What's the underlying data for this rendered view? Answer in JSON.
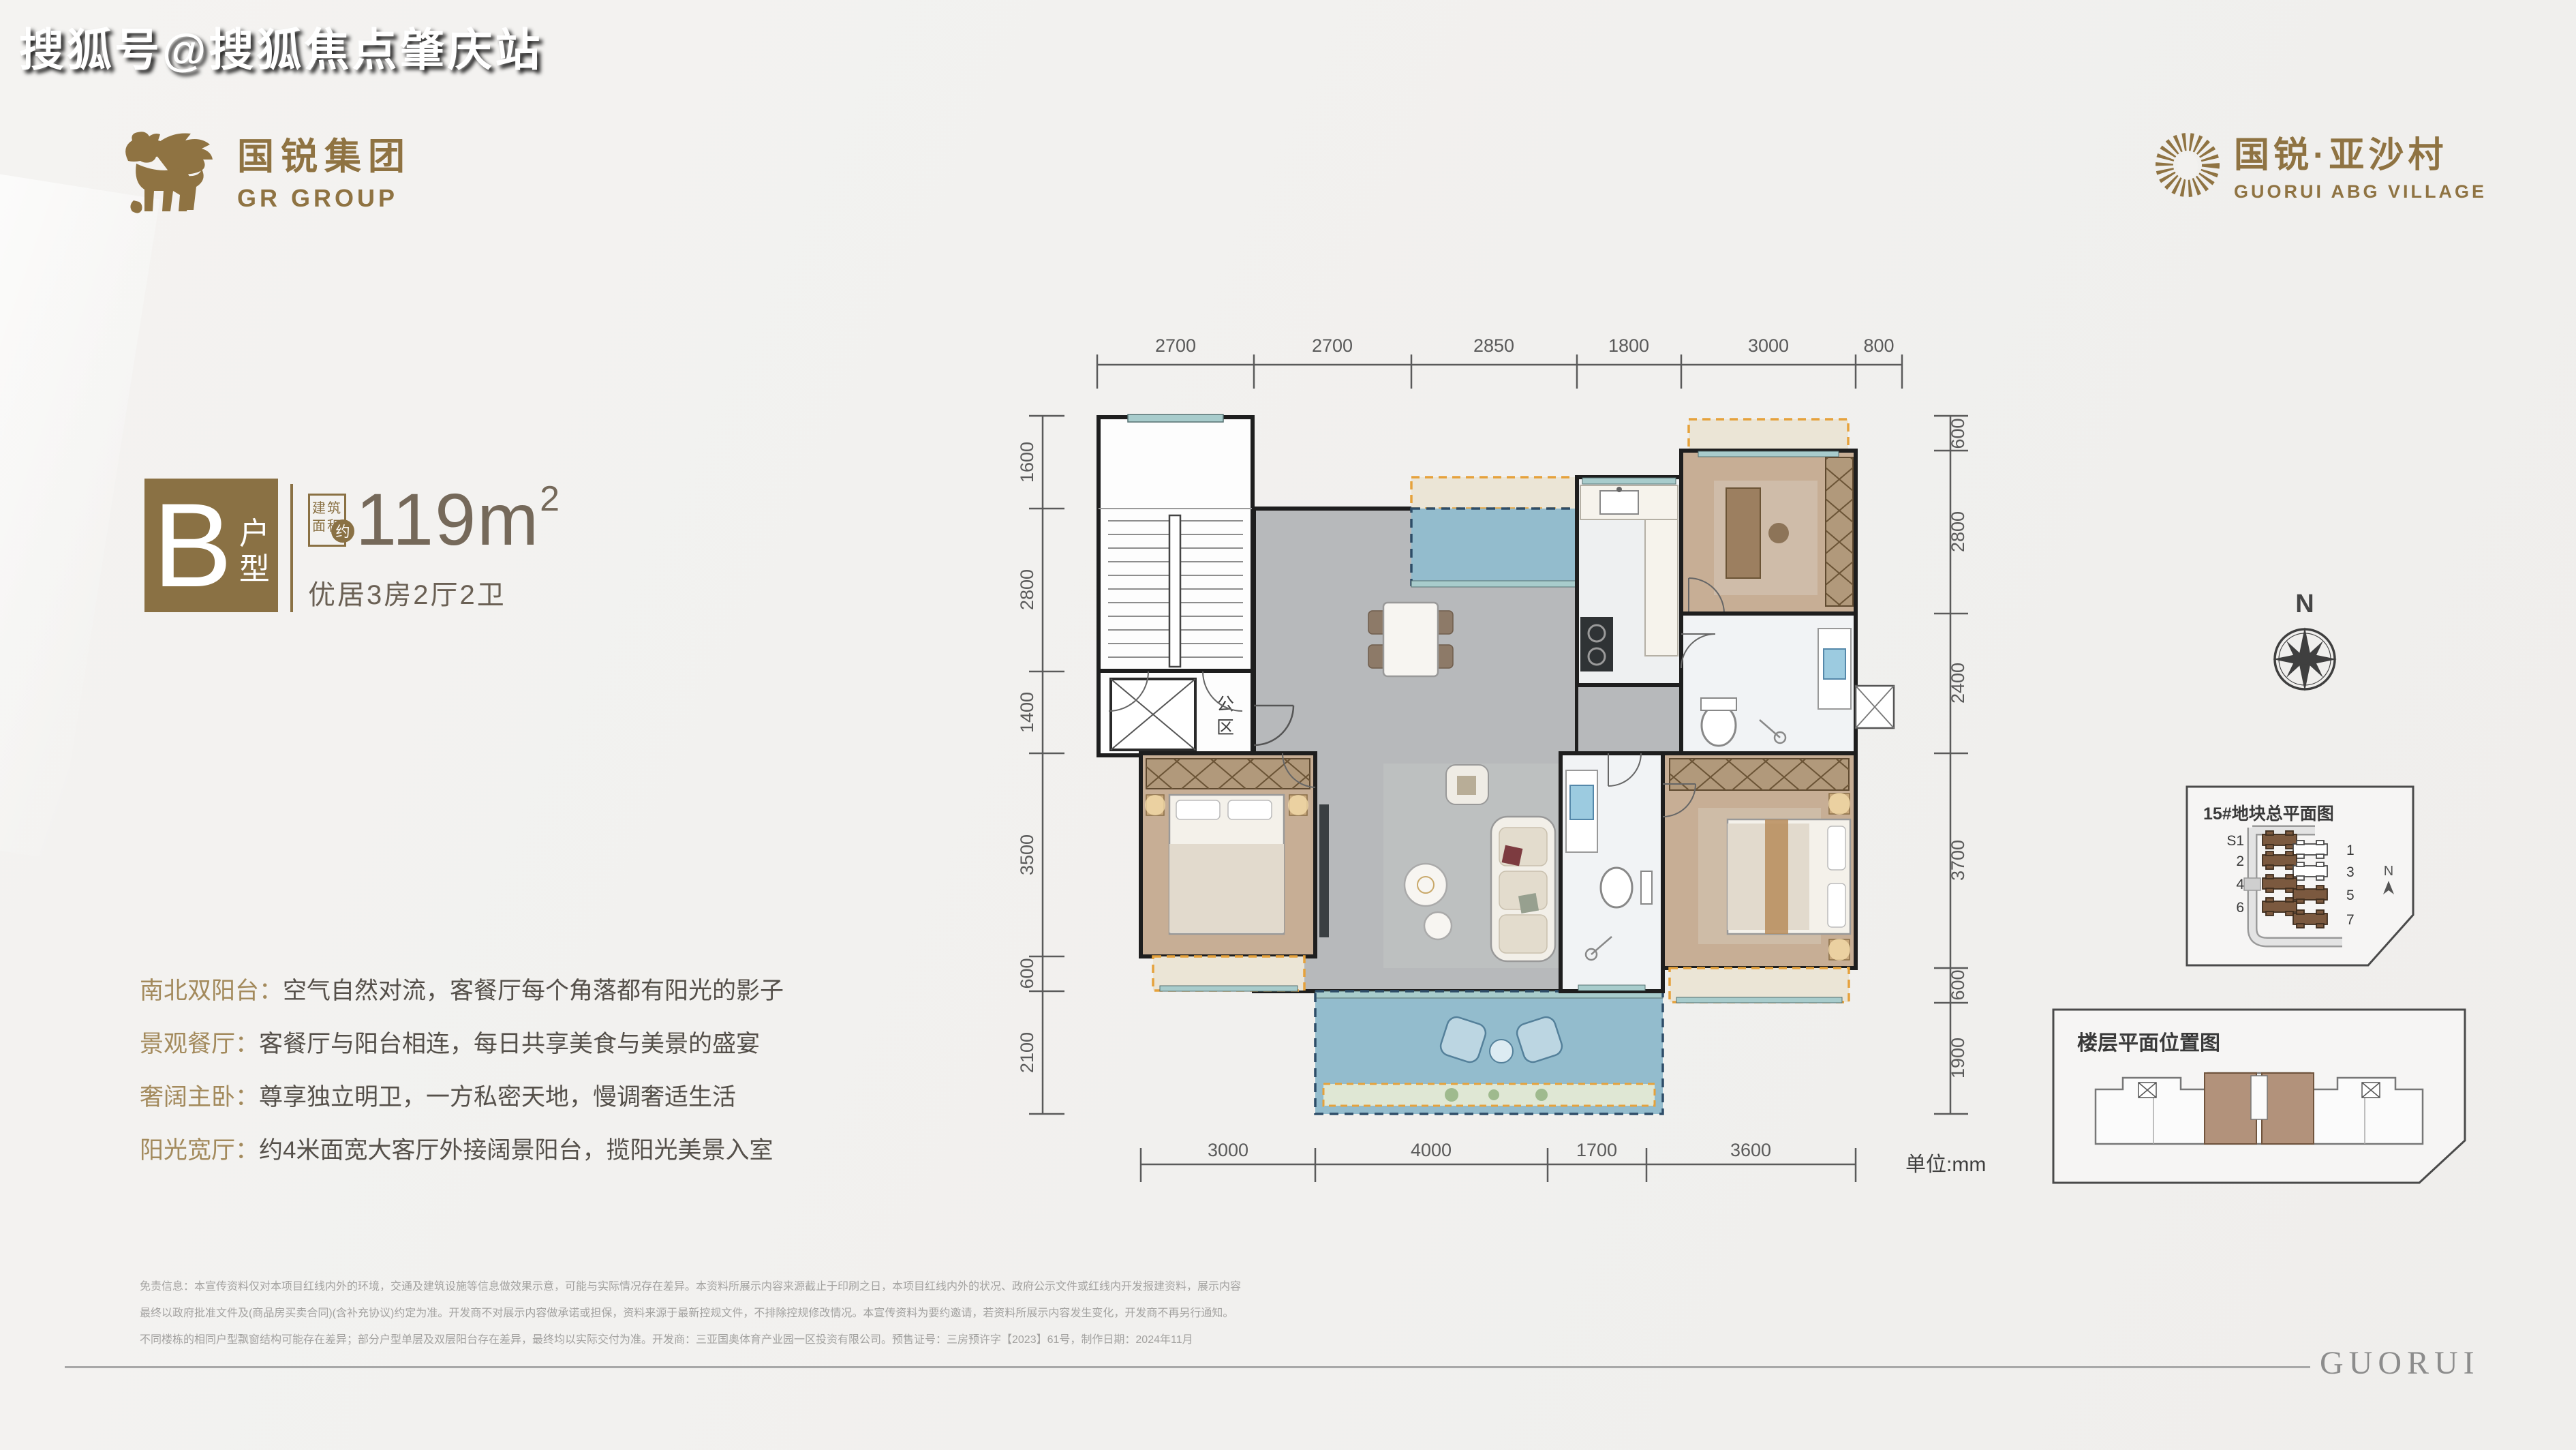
{
  "watermark": "搜狐号@搜狐焦点肇庆站",
  "brand": {
    "name_cn": "国锐集团",
    "name_en": "GR GROUP"
  },
  "project": {
    "name_cn": "国锐·亚沙村",
    "name_en": "GUORUI ABG VILLAGE"
  },
  "unit": {
    "letter": "B",
    "type_chars": [
      "户",
      "型"
    ],
    "area_label_lines": [
      "建筑",
      "面积"
    ],
    "approx": "约",
    "area_value": "119m",
    "area_sup": "2",
    "layout": "优居3房2厅2卫"
  },
  "features": [
    {
      "label": "南北双阳台：",
      "text": "空气自然对流，客餐厅每个角落都有阳光的影子"
    },
    {
      "label": "景观餐厅：",
      "text": "客餐厅与阳台相连，每日共享美食与美景的盛宴"
    },
    {
      "label": "奢阔主卧：",
      "text": "尊享独立明卫，一方私密天地，慢调奢适生活"
    },
    {
      "label": "阳光宽厅：",
      "text": "约4米面宽大客厅外接阔景阳台，揽阳光美景入室"
    }
  ],
  "plan": {
    "unit_note": "单位:mm",
    "public_chars": [
      "公",
      "区"
    ],
    "dims": {
      "top": [
        "2700",
        "2700",
        "2850",
        "1800",
        "3000",
        "800"
      ],
      "bottom": [
        "3000",
        "4000",
        "1700",
        "3600"
      ],
      "left": [
        "1600",
        "2800",
        "1400",
        "3500",
        "600",
        "2100"
      ],
      "right": [
        "600",
        "2800",
        "2400",
        "3700",
        "600",
        "1900"
      ]
    }
  },
  "compass": {
    "label": "N"
  },
  "site_plan": {
    "title": "15#地块总平面图",
    "north": "N",
    "left_labels": [
      "S1",
      "2",
      "4",
      "6"
    ],
    "right_labels": [
      "1",
      "3",
      "5",
      "7"
    ]
  },
  "floor_diagram": {
    "title": "楼层平面位置图"
  },
  "disclaimer": [
    "免责信息：本宣传资料仅对本项目红线内外的环境，交通及建筑设施等信息做效果示意，可能与实际情况存在差异。本资料所展示内容来源截止于印刷之日，本项目红线内外的状况、政府公示文件或红线内开发报建资料，展示内容",
    "最终以政府批准文件及(商品房买卖合同)(含补充协议)约定为准。开发商不对展示内容做承诺或担保，资料来源于最新控规文件，不排除控规修改情况。本宣传资料为要约邀请，若资料所展示内容发生变化，开发商不再另行通知。",
    "不同楼栋的相同户型飘窗结构可能存在差异；部分户型单层及双层阳台存在差异，最终均以实际交付为准。开发商：三亚国奥体育产业园一区投资有限公司。预售证号：三房预许字【2023】61号，制作日期：2024年11月"
  ],
  "footer": {
    "logo_text": "GUORUI"
  },
  "colors": {
    "brand_gold": "#8f7342",
    "panel_brown": "#8a7144",
    "balcony_blue": "#93bccd",
    "highlight_brown": "#b2927b"
  }
}
